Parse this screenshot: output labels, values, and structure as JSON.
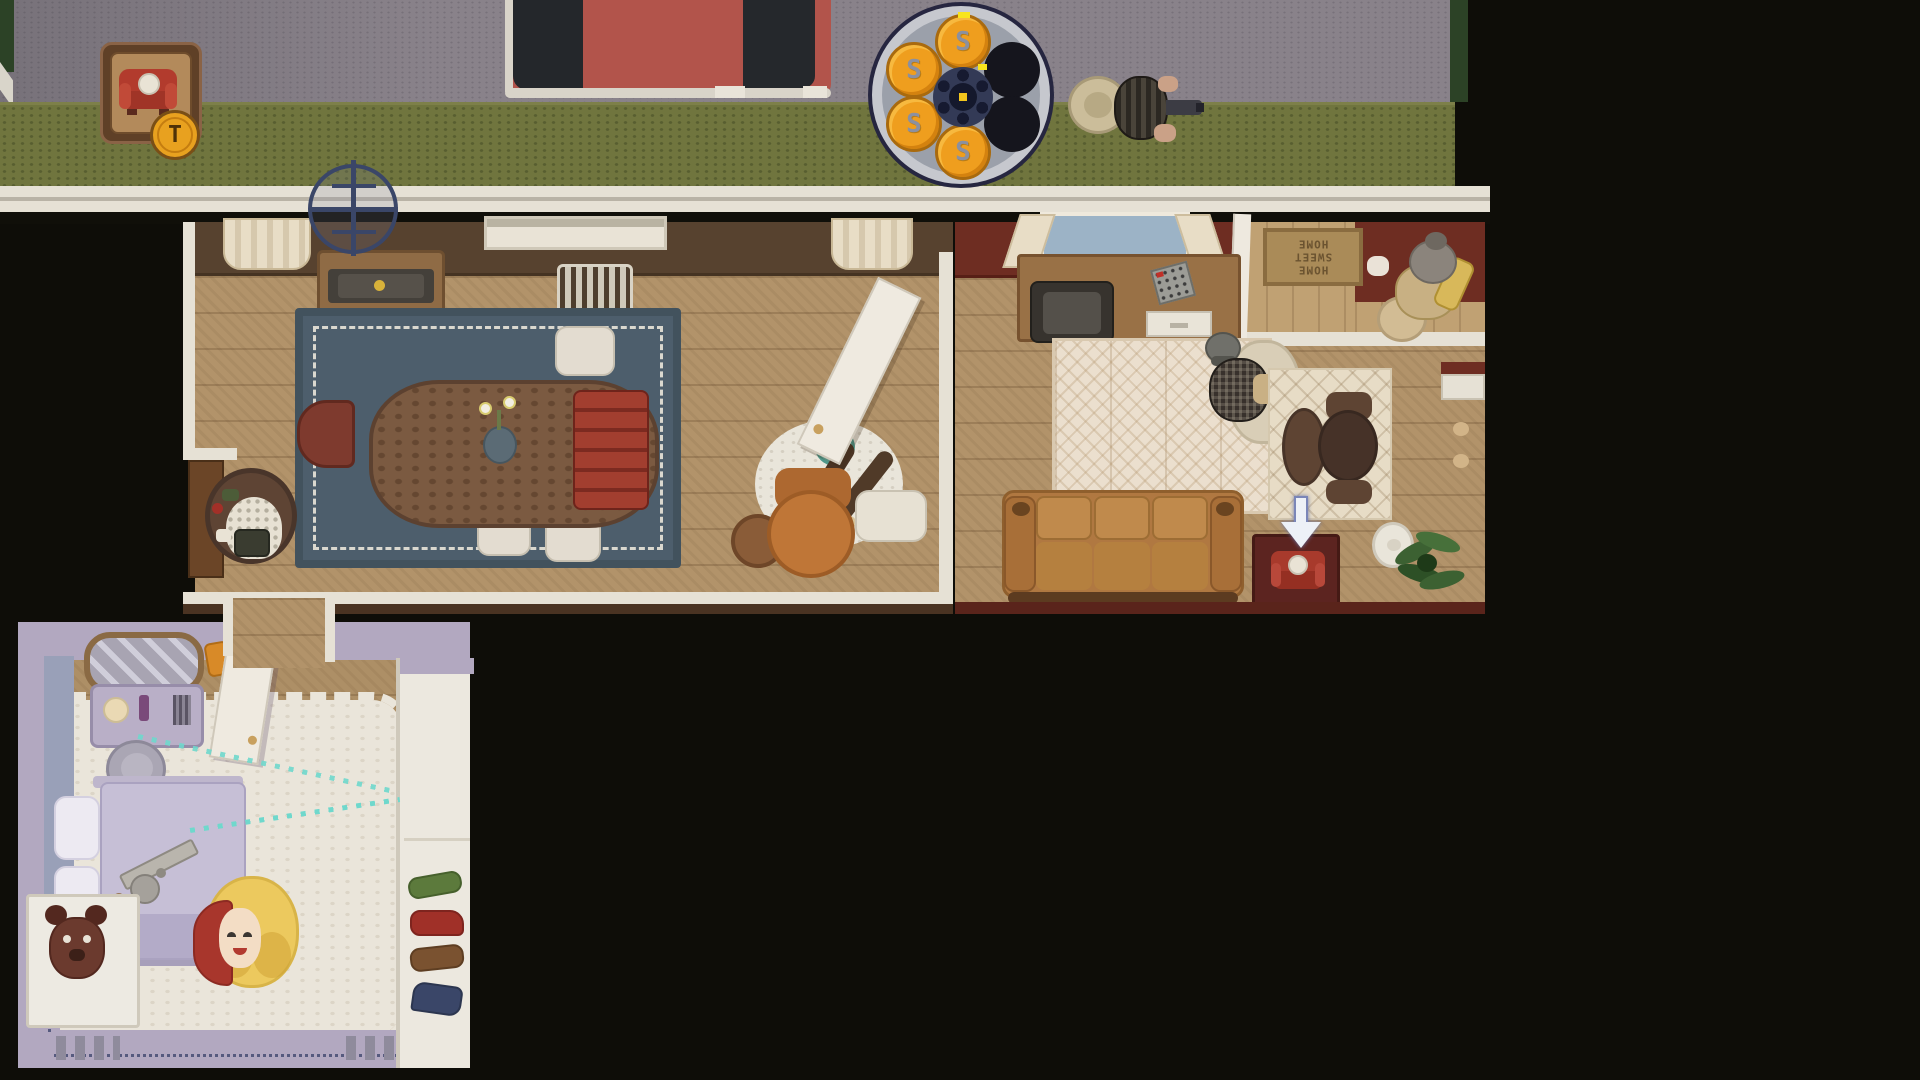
{
  "hud": {
    "item_slot": {
      "key_label": "T",
      "item": "red-couch"
    },
    "revolver_cylinder": {
      "bullet_label": "S",
      "chambers": 6,
      "bullets_loaded": 4,
      "empty_chambers": 2
    }
  },
  "scene": {
    "doormat_text": "HOME\nSWEET\nHOME",
    "rooms": [
      "street",
      "dining-room",
      "living-room",
      "entry-hall",
      "hallway",
      "bedroom"
    ],
    "entities": [
      "player-with-revolver-on-street",
      "npc-in-entry-hall",
      "granny-in-armchair",
      "grandpa-in-chair",
      "woman-lying-in-bedroom",
      "revolver-on-bed",
      "ricochet-trajectory",
      "pickup-arrow-over-mini-couch",
      "fallen-person-legs",
      "yarn-ball",
      "red-car",
      "tv-antenna"
    ]
  },
  "palette": {
    "background": "#0e0d08",
    "road": "#89828a",
    "grass": "#70753e",
    "sidewalk": "#e6e1d5",
    "wood_floor": "#b2936a",
    "dining_wall": "#57422f",
    "living_wall": "#6e2d22",
    "bedroom_wall": "#b2a8c0",
    "rug_blue": "#4d5e6c",
    "rug_cream": "#ebdfce",
    "shag_rug": "#eae5da",
    "couch_orange": "#b57c41",
    "accent_red": "#a83a2c",
    "bullet_gold": "#ef9e1e",
    "coin_gold": "#e8a11f",
    "trajectory_teal": "#6fd8cc",
    "arrow_white": "#edf1f7",
    "car_red": "#b2544b"
  }
}
